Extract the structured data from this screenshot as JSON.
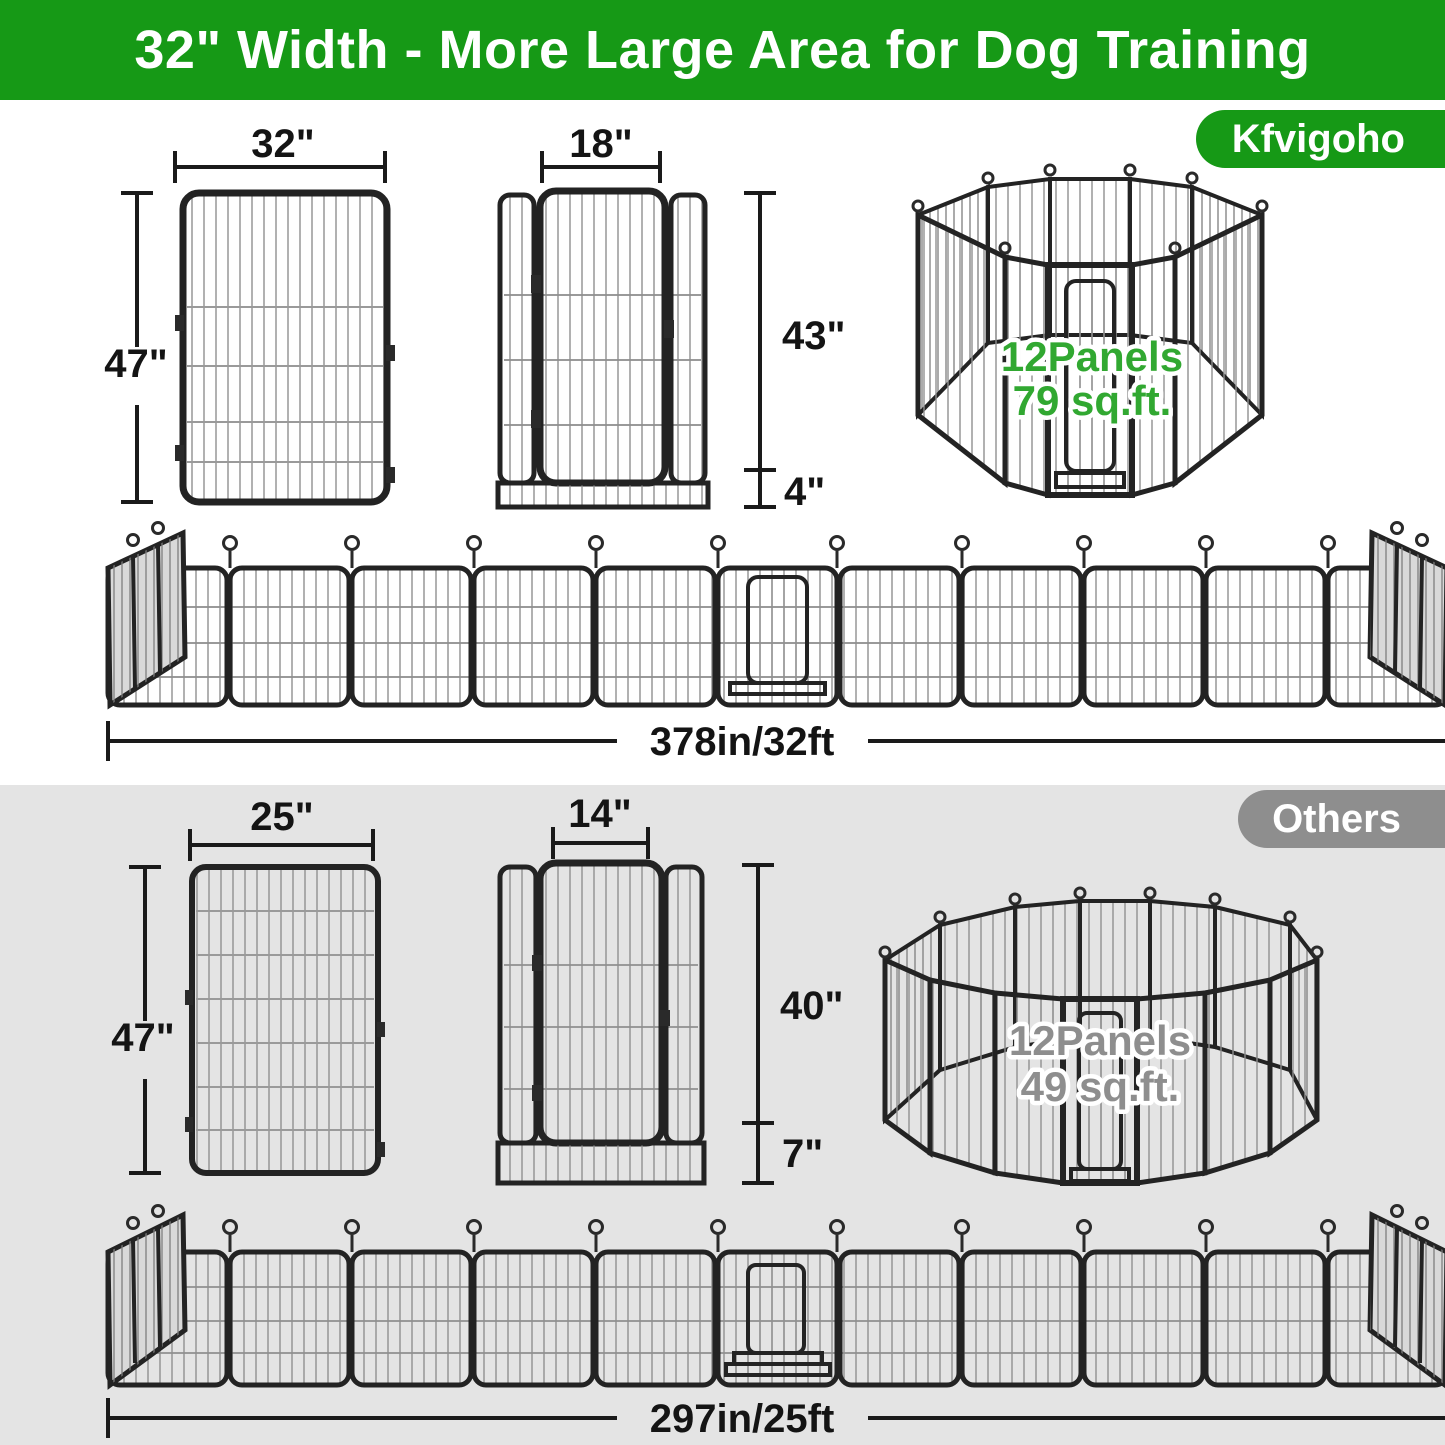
{
  "banner": {
    "title": "32\" Width - More Large Area for Dog Training"
  },
  "brand_badge": {
    "label": "Kfvigoho"
  },
  "others_badge": {
    "label": "Others"
  },
  "kfvigoho_section": {
    "panel": {
      "width_label": "32\"",
      "height_label": "47\""
    },
    "door_panel": {
      "width_label": "18\"",
      "height_label": "43\"",
      "bottom_label": "4\""
    },
    "pen": {
      "line1": "12Panels",
      "line2": "79 sq.ft."
    },
    "row": {
      "length_label": "378in/32ft"
    }
  },
  "others_section": {
    "panel": {
      "width_label": "25\"",
      "height_label": "47\""
    },
    "door_panel": {
      "width_label": "14\"",
      "height_label": "40\"",
      "bottom_label": "7\""
    },
    "pen": {
      "line1": "12Panels",
      "line2": "49 sq.ft."
    },
    "row": {
      "length_label": "297in/25ft"
    }
  },
  "colors": {
    "brand_green": "#169916",
    "highlight_green": "#31A831",
    "badge_gray": "#8E8E8E",
    "section_gray": "#E4E4E4"
  }
}
